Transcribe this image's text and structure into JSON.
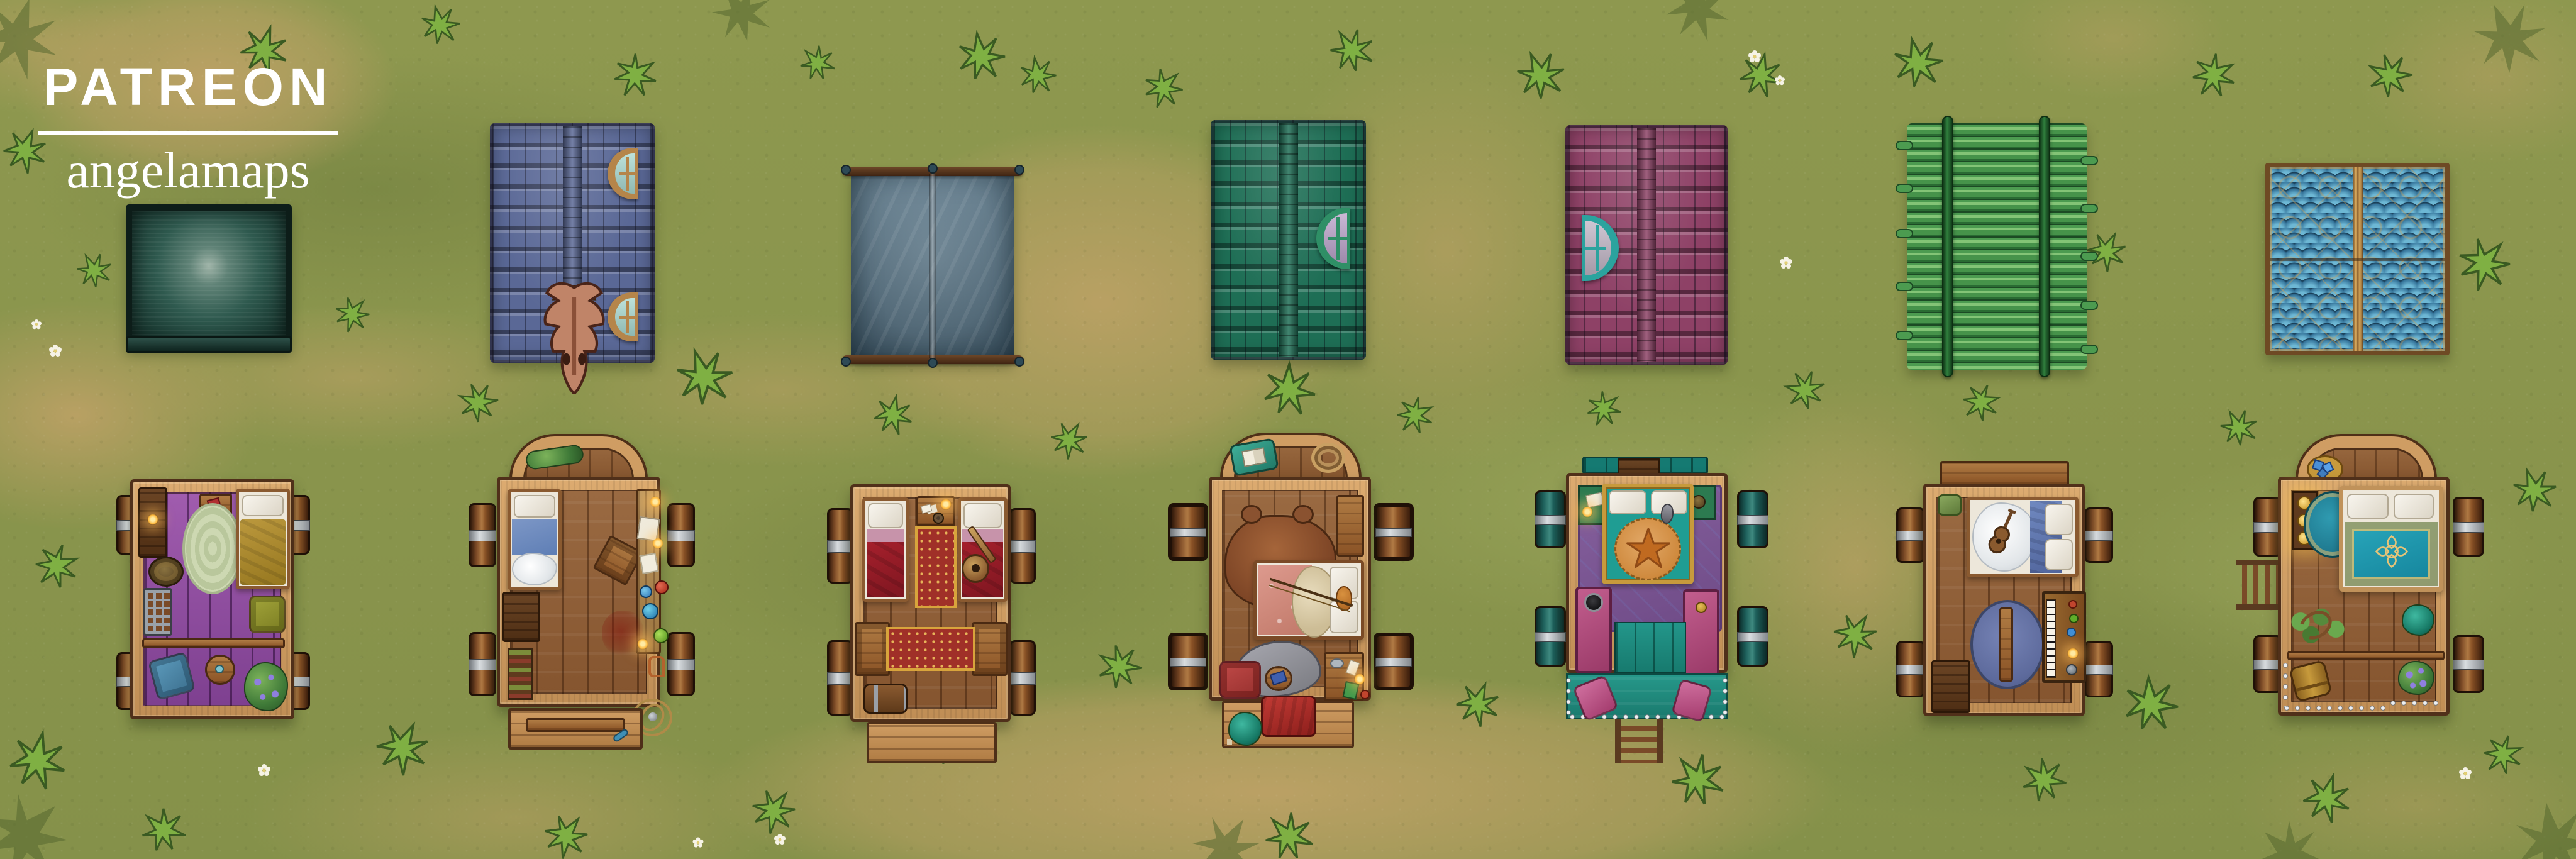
{
  "brand": {
    "title": "PATREON",
    "subtitle": "angelamaps",
    "text_color": "#ffffff"
  },
  "scene": {
    "type": "top-down battle map",
    "setting": "grassy field with dirt patches, star-shaped grass tufts and small white daisies",
    "rows": [
      {
        "name": "covered wagon roofs",
        "count": 7
      },
      {
        "name": "open wagon interiors",
        "count": 7
      }
    ]
  },
  "ground": {
    "grass": "#8a9750",
    "grass_dark": "#68793c",
    "grass_light": "#a5b164",
    "dirt": "#c4a369",
    "tuft": "#7fb043",
    "daisy_petal": "#f6f3e6",
    "daisy_center": "#e3cf74"
  },
  "roofs": [
    {
      "id": "roof-canvas",
      "label": "weathered teal canvas wagon top",
      "color": "#2e5d52"
    },
    {
      "id": "roof-blue-shingles",
      "label": "blue shingled roof with dragon skull and two dormer windows",
      "color": "#5a6896",
      "dormer_frame": "#b5854a",
      "dormer_glass": "#a7d8cf",
      "skull": "#c98a70"
    },
    {
      "id": "roof-tent",
      "label": "grey canvas tent stretched on wooden poles",
      "color": "#5d7889",
      "pole": "#503019"
    },
    {
      "id": "roof-green-shingles",
      "label": "green shingled roof with one dormer window",
      "color": "#1e6e55",
      "dormer_frame": "#2f8f66",
      "dormer_glass": "#b9a1c8"
    },
    {
      "id": "roof-plum-shingles",
      "label": "plum shingled roof with one dormer window",
      "color": "#8e4166",
      "dormer_frame": "#2ba39e",
      "dormer_glass": "#c0b4c4"
    },
    {
      "id": "roof-bamboo",
      "label": "green bamboo-pole roof bound by two rails",
      "color": "#46934a",
      "rail": "#2f7d3c"
    },
    {
      "id": "roof-scales",
      "label": "blue scale roof with gold filigree in four quadrants",
      "color": "#35749a",
      "gold": "#c89a55"
    }
  ],
  "wagons": [
    {
      "id": "wagon-purple",
      "label": "open wagon with purple floor",
      "floor": "#9a58a8",
      "furniture": [
        "sideboard with lit candle",
        "nightstand with red book",
        "braided oval rug",
        "bed with olive blanket",
        "bronze gong",
        "iron stove crate",
        "olive armchair",
        "divider rail",
        "blue armchair",
        "round table with cup",
        "potted purple flowers"
      ]
    },
    {
      "id": "wagon-alchemist",
      "label": "arched wagon with alchemy workbench",
      "floor": "#8a5c38",
      "furniture": [
        "plant garland in arch",
        "bed with blue blanket and fur throw",
        "dark crate",
        "bottle rack",
        "tipped stool",
        "workbench with candles, books, papers and potions",
        "blood stain",
        "armillary sphere",
        "tailgate with blue bottle"
      ]
    },
    {
      "id": "wagon-twin-beds",
      "label": "wagon with two red beds",
      "floor": "#8a5c38",
      "furniture": [
        "left red bed",
        "right red bed with lute",
        "small table with candle, cards and pan",
        "red runner rug",
        "two wooden benches",
        "horizontal red rug",
        "banded barrel chest",
        "rear step"
      ]
    },
    {
      "id": "wagon-hunter",
      "label": "arched wagon with bearskin rug and sleeping wolf",
      "floor": "#8a5c38",
      "furniture": [
        "teal pillow with open book",
        "rope coil",
        "bearskin rug",
        "bed with floral blanket, fur, pillows and bow",
        "wooden bench",
        "grey wolf",
        "red armchair",
        "round side table with blue book",
        "desk with bowl, cards and candle",
        "step with red cushion",
        "teal potted plant"
      ]
    },
    {
      "id": "wagon-fancy",
      "label": "wagon with gold-framed bed and starfish throw",
      "floor": "#1f8a78",
      "furniture": [
        "teal headboard",
        "top step",
        "ornate purple rug",
        "corner shelf with letter and candle",
        "corner shelf with bronze disc",
        "gold-framed bed with teal blanket and starfish throw",
        "cat",
        "two pink benches",
        "teal plank floor",
        "riveted teal porch",
        "two pink chairs",
        "ladder"
      ]
    },
    {
      "id": "wagon-musician",
      "label": "wagon with violin bed and upright piano",
      "floor": "#8a5c38",
      "furniture": [
        "driver platform",
        "green backpack",
        "bed with fur, blue blanket and violin",
        "round blue rug",
        "wooden bench",
        "upright piano with trinkets and candle",
        "dark crate"
      ]
    },
    {
      "id": "wagon-treasure",
      "label": "arched wagon with teal emblem bed and plants",
      "floor": "#8a5c38",
      "furniture": [
        "basket of blue crystals",
        "glowing gold shelf",
        "teal round rug",
        "bed with teal duvet and gold emblem",
        "vine plant",
        "teal plant",
        "divider rail",
        "small barrel",
        "purple flower pot",
        "riveted edge",
        "side ladder"
      ]
    }
  ],
  "palette": {
    "wagon_frame": "#cf9d63",
    "wagon_frame_dark": "#4e2f18",
    "wheel_wood": "#7c4a28",
    "wheel_metal": "#c9ced2",
    "wheel_teal": "#2e6e66",
    "candle_glow": "#ffb93d",
    "bed_red": "#a5202c",
    "bed_blue": "#5e7eb5",
    "bed_teal": "#1f9d93",
    "rug_purple": "#7c5494",
    "bench_pink": "#b14a7e"
  }
}
